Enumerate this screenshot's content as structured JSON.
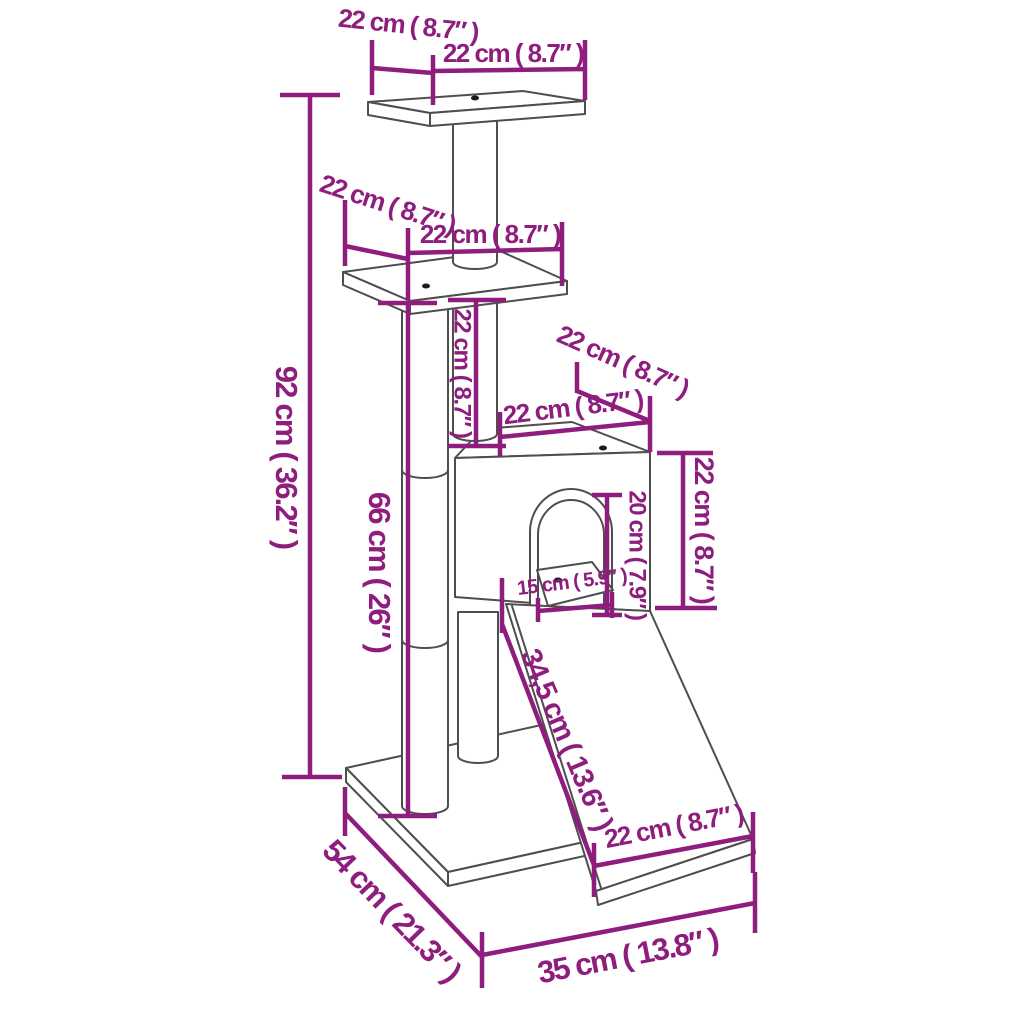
{
  "diagram": {
    "type": "product-dimension-diagram",
    "subject": "cat tree with scratching posts, condo and ramp",
    "units": [
      "cm",
      "inch"
    ],
    "colors": {
      "dimension": "#8e1d7e",
      "structure": "#4e4e4e",
      "background": "#ffffff",
      "screw_dot": "#1a1a1a"
    },
    "labels": {
      "total_height": "92 cm ( 36.2″ )",
      "left_post_height": "66 cm ( 26″ )",
      "top_platform_depth": "22 cm ( 8.7″ )",
      "top_platform_width": "22 cm ( 8.7″ )",
      "middle_platform_depth": "22 cm ( 8.7″ )",
      "middle_platform_width": "22 cm ( 8.7″ )",
      "upper_post_height": "22 cm ( 8.7″ )",
      "condo_top_depth": "22 cm ( 8.7″ )",
      "condo_top_width": "22 cm ( 8.7″ )",
      "condo_height": "22 cm ( 8.7″ )",
      "door_height": "20 cm ( 7.9″ )",
      "door_width": "15 cm ( 5.9″ )",
      "ramp_length": "34,5 cm ( 13.6″ )",
      "ramp_width": "22 cm ( 8.7″ )",
      "base_depth": "54 cm ( 21.3″ )",
      "base_width": "35 cm ( 13.8″ )"
    }
  }
}
